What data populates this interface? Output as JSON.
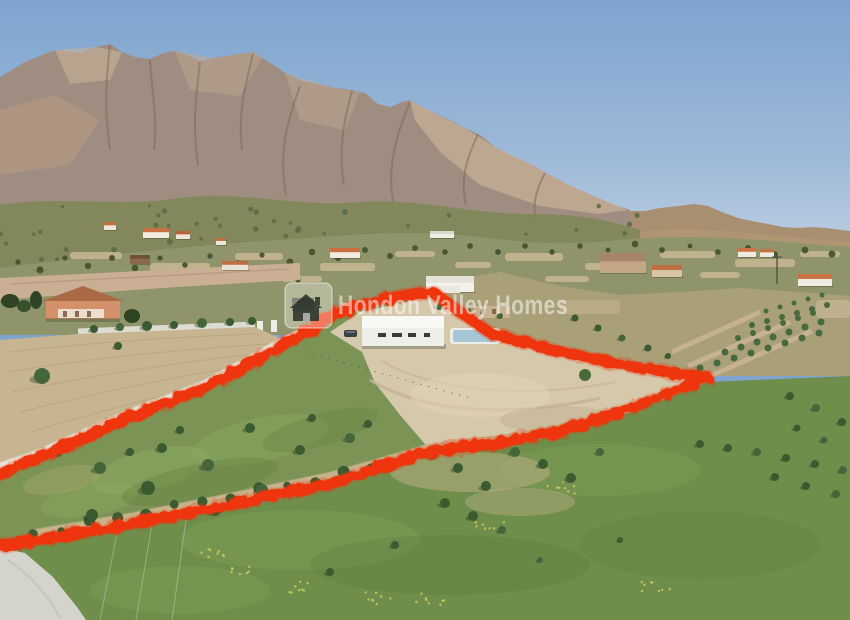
{
  "window": {
    "width": 850,
    "height": 620
  },
  "watermark": {
    "text": "Hondon Valley Homes",
    "icon": "house-icon",
    "text_opacity": 0.52
  },
  "scene": {
    "type": "aerial-drone-photograph",
    "subject": "Rural building plot outlined with a hand-drawn red boundary; new-build white villa with pool on graded dirt inside the plot; green almond orchard fields and meadows around; ploughed field, white wall and salmon villa at left; gravel road at bottom-left; scattered country houses on the hillside; rocky mountain range under a clear blue sky",
    "colors": {
      "boundary_red": "#ee3407",
      "sky_top": "#7ea4cf",
      "sky_horizon": "#bccde1",
      "mountain_rock": "#9e8d80",
      "mountain_sunlit": "#c6ae95",
      "hillside_olive": "#90946a",
      "ploughed_field_tan": "#c7b592",
      "plot_green": "#7b9455",
      "plot_dirt": "#d5c8ab",
      "meadow_green": "#6f8e4c",
      "road_grey": "#d4d4cc",
      "building_white": "#efefea",
      "pool_blue": "#a6c8d6"
    }
  }
}
